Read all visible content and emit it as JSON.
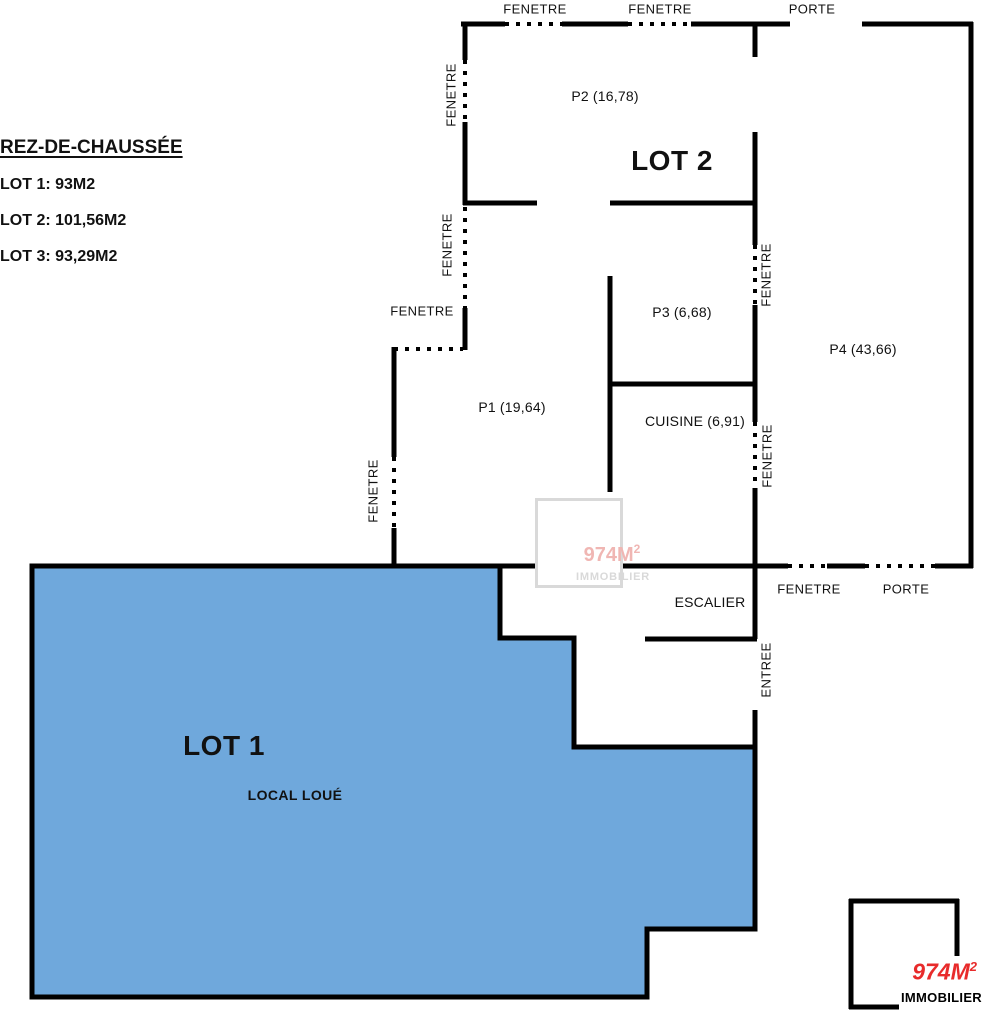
{
  "legend": {
    "title": "REZ-DE-CHAUSSÉE",
    "lot1": "LOT 1: 93M2",
    "lot2": "LOT 2: 101,56M2",
    "lot3": "LOT 3: 93,29M2"
  },
  "rooms": {
    "p1": "P1 (19,64)",
    "p2": "P2 (16,78)",
    "p3": "P3 (6,68)",
    "p4": "P4 (43,66)",
    "cuisine": "CUISINE (6,91)",
    "escalier": "ESCALIER",
    "lot1_title": "LOT 1",
    "lot2_title": "LOT 2",
    "local_loue": "LOCAL LOUÉ"
  },
  "openings": {
    "fenetre": "FENETRE",
    "porte": "PORTE",
    "entree": "ENTREE"
  },
  "watermark": {
    "brand_base": "974M",
    "brand_exp": "2",
    "subtitle": "IMMOBILIER"
  },
  "logo": {
    "brand_base": "974M",
    "brand_exp": "2",
    "subtitle": "IMMOBILIER"
  },
  "colors": {
    "wall": "#000000",
    "lot1_fill": "#6fa8dc",
    "logo_red": "#e82b2b",
    "watermark_gray": "#d9d9d9",
    "watermark_pink": "#f0b6b3"
  }
}
